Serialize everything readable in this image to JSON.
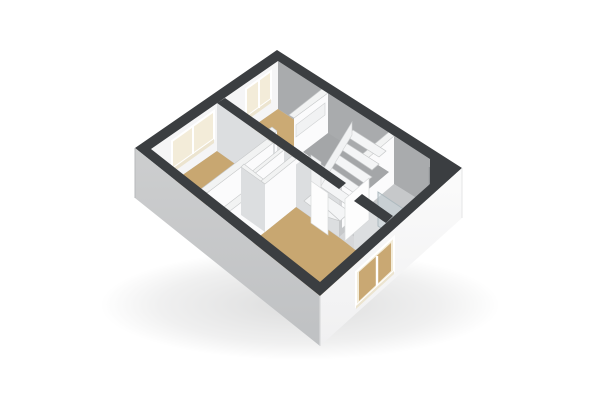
{
  "meta": {
    "title": "3D floor plan render",
    "view": "axonometric top-down",
    "background": "#ffffff"
  },
  "palette": {
    "exterior_wall_top": "#3b3e41",
    "interior_wall_top": "#f2f3f3",
    "facade_light": "#fafafa",
    "facade_shaded": "#c9cacc",
    "floor_wood": "#c8a771",
    "floor_grey": "#c6c8ca",
    "stair_void": "#a4a6a8",
    "window_light": "#f3ecd9",
    "shower_glass": "#cbd6db"
  },
  "rooms": [
    {
      "name": "bedroom-top",
      "floor": "wood-tan",
      "window": "top-left facade"
    },
    {
      "name": "bedroom-left",
      "floor": "wood-tan",
      "window": "top-left facade"
    },
    {
      "name": "living-room-bottom",
      "floor": "wood-tan",
      "window": "bottom-right facade"
    },
    {
      "name": "stairwell-landing",
      "floor": "grey",
      "feature": "winder staircase"
    },
    {
      "name": "bathroom",
      "floor": "grey",
      "feature": "corner glass shower"
    },
    {
      "name": "closets",
      "floor": "grey",
      "cells": 2
    }
  ],
  "features": {
    "windows": 3,
    "stair_treads": 7,
    "door_leaves": 2,
    "chamfered_corner": "right (duct)",
    "shadow": "soft drop shadow under building"
  }
}
